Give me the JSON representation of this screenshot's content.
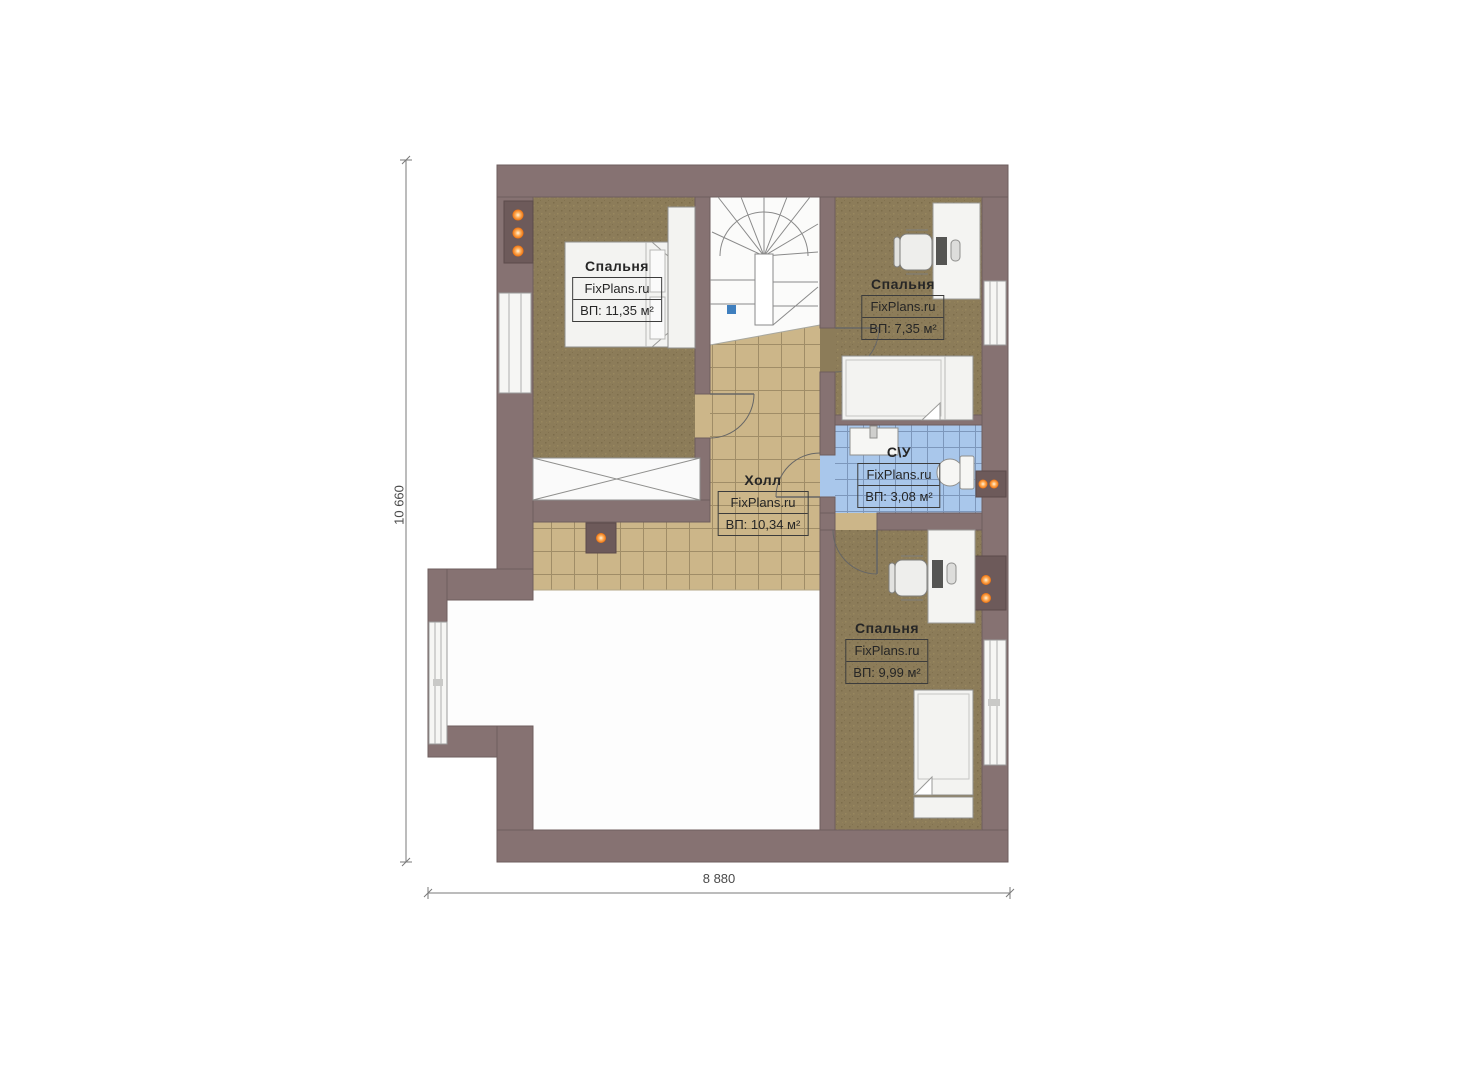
{
  "plan": {
    "watermark": "FixPlans.ru",
    "dimensions": {
      "height_label": "10 660",
      "width_label": "8 880"
    },
    "rooms": [
      {
        "id": "bedroom-left",
        "name": "Спальня",
        "watermark": "FixPlans.ru",
        "area": "ВП: 11,35 м²"
      },
      {
        "id": "bedroom-top-right",
        "name": "Спальня",
        "watermark": "FixPlans.ru",
        "area": "ВП: 7,35 м²"
      },
      {
        "id": "bathroom",
        "name": "С\\У",
        "watermark": "FixPlans.ru",
        "area": "ВП: 3,08 м²"
      },
      {
        "id": "hall",
        "name": "Холл",
        "watermark": "FixPlans.ru",
        "area": "ВП: 10,34 м²"
      },
      {
        "id": "bedroom-bottom",
        "name": "Спальня",
        "watermark": "FixPlans.ru",
        "area": "ВП: 9,99 м²"
      }
    ],
    "colors": {
      "wall": "#867272",
      "wall_niche": "#6d5a5a",
      "carpet": "#8c7c59",
      "hall_tile": "#ccb689",
      "bath_tile": "#a9c7eb",
      "floor_white": "#fdfdfd",
      "light_dot": "#ee7711",
      "stair_marker_blue": "#3f7fbe"
    }
  }
}
